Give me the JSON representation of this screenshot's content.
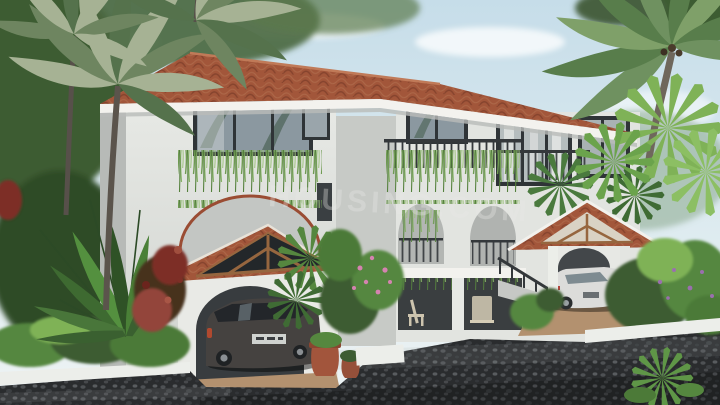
{
  "watermark": {
    "text": "HOUSING.COM"
  },
  "scene": {
    "objects": [
      "three-storey-mediterranean-villa",
      "terracotta-tile-hipped-roof",
      "left-carport-with-dark-suv",
      "right-carport-with-white-car",
      "balconies-with-hanging-vines",
      "arched-openings",
      "coconut-and-fan-palms",
      "travelers-palm",
      "red-bougainvillea",
      "pink-flowers",
      "purple-flowers",
      "terracotta-pots",
      "cobblestone-driveway",
      "white-planter-walls",
      "veranda-with-chairs"
    ]
  },
  "palette": {
    "sky1": "#cbe0ea",
    "sky2": "#eef3f4",
    "roof": "#a2563a",
    "roof_line": "#7c3a26",
    "wall": "#e2e4e0",
    "wall_shadow": "#b7bab7",
    "wall_recess": "#c7cac6",
    "fascia": "#f3f2ee",
    "frame": "#2f3437",
    "glass": "#8b98a0",
    "rail": "#34383b",
    "vine": "#6f9b52",
    "foliage_dark": "#3c5c33",
    "foliage_mid": "#55873f",
    "foliage_light": "#7fb257",
    "palm_sage": "#a6b294",
    "flower_red": "#7d2f26",
    "flower_pink": "#d583b0",
    "flower_purple": "#9a6fae",
    "pot": "#a2553c",
    "drive": "#2a2c2e",
    "suv": "#454240",
    "white_car": "#dcdcda",
    "wood": "#96663f",
    "planter": "#eceeea",
    "tan": "#b3916f",
    "watermark": "#e9e9e7"
  }
}
